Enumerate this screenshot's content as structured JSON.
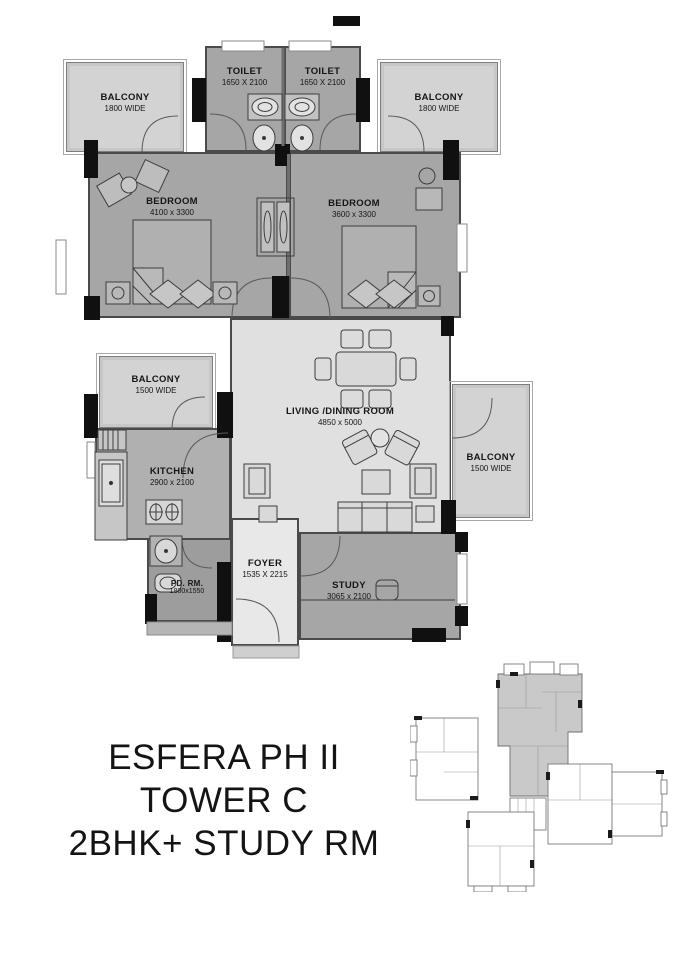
{
  "title": {
    "lines": [
      "ESFERA PH II",
      "TOWER C",
      "2BHK+ STUDY RM"
    ]
  },
  "rooms": {
    "toilet_left": {
      "name": "TOILET",
      "dims": "1650 X 2100"
    },
    "toilet_right": {
      "name": "TOILET",
      "dims": "1650 X 2100"
    },
    "balcony_top_left": {
      "name": "BALCONY",
      "dims": "1800 WIDE"
    },
    "balcony_top_right": {
      "name": "BALCONY",
      "dims": "1800 WIDE"
    },
    "bedroom_left": {
      "name": "BEDROOM",
      "dims": "4100 x 3300"
    },
    "bedroom_right": {
      "name": "BEDROOM",
      "dims": "3600 x 3300"
    },
    "living_dining": {
      "name": "LIVING /DINING ROOM",
      "dims": "4850 x 5000"
    },
    "kitchen": {
      "name": "KITCHEN",
      "dims": "2900 x 2100"
    },
    "balcony_kitchen": {
      "name": "BALCONY",
      "dims": "1500 WIDE"
    },
    "balcony_right": {
      "name": "BALCONY",
      "dims": "1500 WIDE"
    },
    "foyer": {
      "name": "FOYER",
      "dims": "1535 X 2215"
    },
    "study": {
      "name": "STUDY",
      "dims": "3065 x 2100"
    },
    "powder_room": {
      "name": "PD. RM.",
      "dims": "1800x1550"
    }
  },
  "palette": {
    "wall": "#111111",
    "room_fill": "#a6a6a6",
    "living_fill": "#e0e0e0",
    "foyer_fill": "#e8e8e8",
    "balcony_fill": "#d3d3d3",
    "background": "#ffffff",
    "text": "#141414"
  }
}
